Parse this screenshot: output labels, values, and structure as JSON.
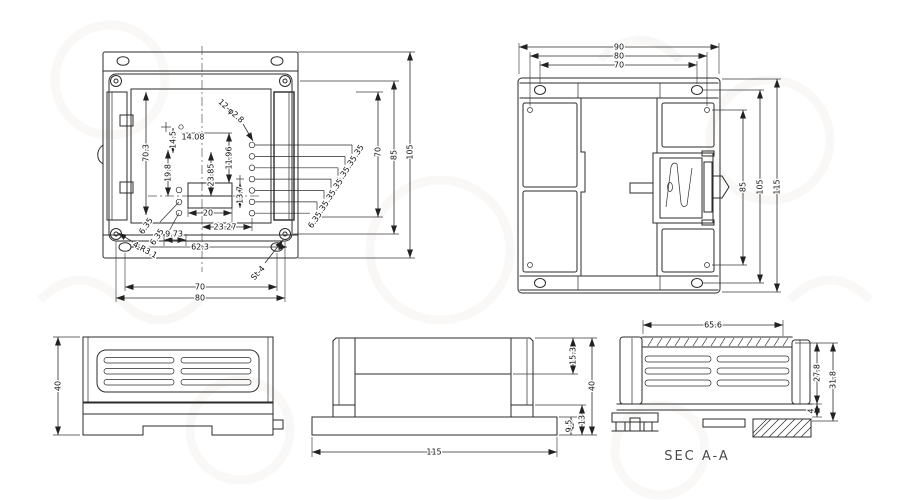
{
  "views": {
    "top": {
      "dims": {
        "d105": "105",
        "d85": "85",
        "d70_right": "70",
        "d70_3": "70.3",
        "d14_08": "14.08",
        "d14_5": "14.5",
        "d19_8": "19.8",
        "d23_85": "23.85",
        "d11_96": "11.96",
        "d13_7": "13.7",
        "d20": "20",
        "d23_27": "23.27",
        "d9_73": "9.73",
        "d62_3": "62.3",
        "d70_bottom": "70",
        "d80": "80",
        "pitch": "6.35"
      },
      "callouts": {
        "holes": "12-φ2.8",
        "corner": "4-R3.1",
        "screw": "St-4"
      }
    },
    "bottom": {
      "dims": {
        "d90": "90",
        "d80": "80",
        "d70": "70",
        "d85": "85",
        "d105": "105",
        "d115": "115"
      }
    },
    "side": {
      "dims": {
        "d40": "40"
      }
    },
    "front": {
      "dims": {
        "d15_3": "15.3",
        "d40": "40",
        "d13": "13",
        "d9_5": "9.5",
        "d115": "115"
      }
    },
    "section": {
      "dims": {
        "d65_6": "65.6",
        "d27_8": "27.8",
        "d31_8": "31.8",
        "d4": "4"
      },
      "title": "SEC A-A"
    }
  }
}
